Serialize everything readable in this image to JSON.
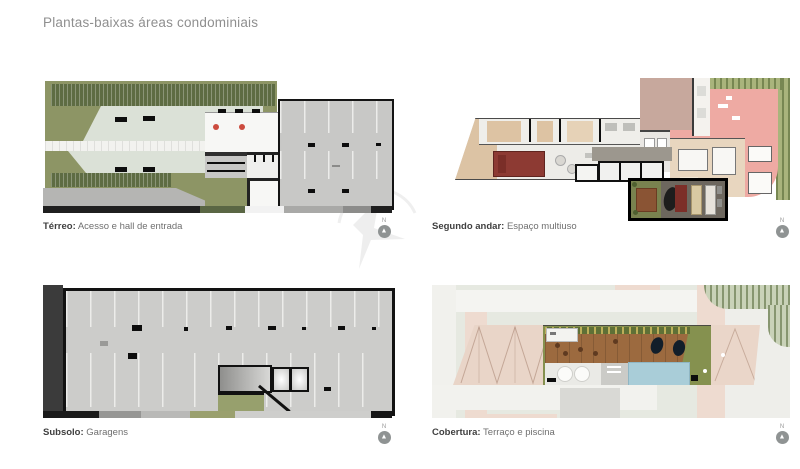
{
  "page": {
    "title": "Plantas-baixas áreas condominiais"
  },
  "plans": [
    {
      "name": "terreo",
      "caption_term": "Térreo:",
      "caption_desc": " Acesso e hall de entrada",
      "north_label": "N"
    },
    {
      "name": "segundo-andar",
      "caption_term": "Segundo andar:",
      "caption_desc": " Espaço multiuso",
      "north_label": "N"
    },
    {
      "name": "subsolo",
      "caption_term": "Subsolo:",
      "caption_desc": " Garagens",
      "north_label": "N"
    },
    {
      "name": "cobertura",
      "caption_term": "Cobertura:",
      "caption_desc": " Terraço e piscina",
      "north_label": "N"
    }
  ],
  "colors": {
    "title_text": "#8f8f8f",
    "caption_term": "#3f3f3f",
    "caption_desc": "#6f6f6f",
    "landscape_green": "#8d9565",
    "hedge_green": "#5e6c43",
    "plaza_gray_green": "#dbe1d7",
    "parking_gray": "#c8c8c6",
    "plan_outline_black": "#141414",
    "dark_wedge": "#3b3b3b",
    "terrace_salmon": "#eeaaa3",
    "room_beige": "#e8d6bf",
    "bed_red": "#8d3a33",
    "multiuso_floor": "#6d675e",
    "multiuso_green": "#79824f",
    "roof_pink": "#e9d5c8",
    "deck_brown": "#9c6a3f",
    "pool_blue": "#a9cdd8",
    "grass_olive": "#85914f",
    "north_icon_gray": "#8f9393"
  }
}
